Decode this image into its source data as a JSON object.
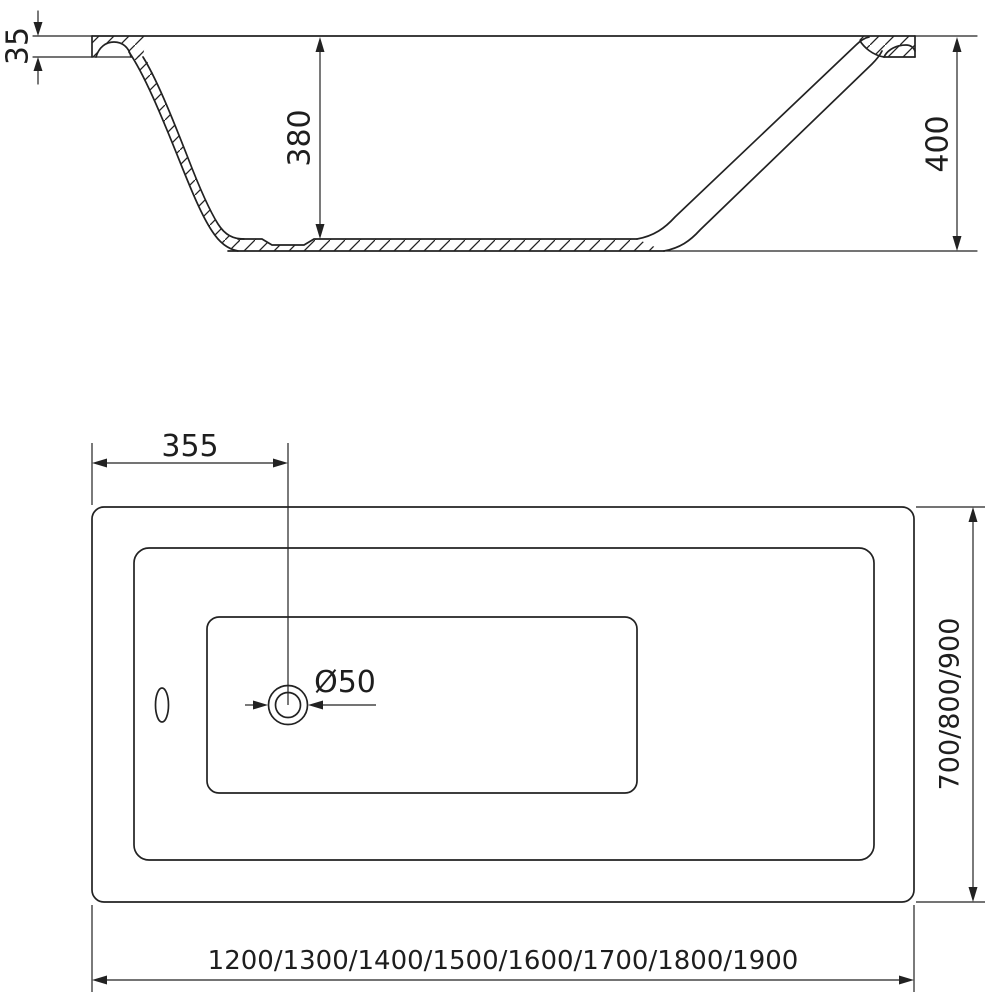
{
  "colors": {
    "line": "#222222",
    "background": "#ffffff"
  },
  "side_view": {
    "rim_thickness": "35",
    "inner_depth": "380",
    "total_height": "400"
  },
  "top_view": {
    "drain_offset": "355",
    "drain_diameter": "Ø50",
    "width_options": "700/800/900",
    "length_options": "1200/1300/1400/1500/1600/1700/1800/1900"
  }
}
